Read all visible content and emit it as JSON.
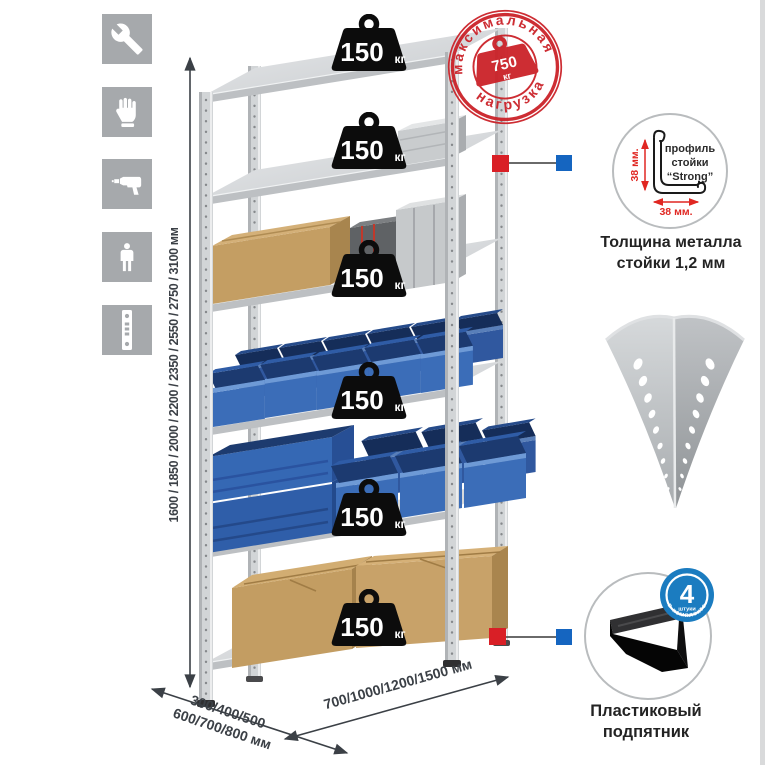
{
  "sidebar": {
    "icons": [
      {
        "id": "wrench",
        "meaning": "wrench tool"
      },
      {
        "id": "gloves",
        "meaning": "work gloves"
      },
      {
        "id": "drill",
        "meaning": "power drill"
      },
      {
        "id": "person",
        "meaning": "assembler person"
      },
      {
        "id": "post",
        "meaning": "perforated post strip"
      }
    ]
  },
  "dimensions": {
    "height": "1600 / 1850 / 2000 / 2200 / 2350 / 2550 / 2750 / 3100 мм",
    "depth_line1": "300/400/500",
    "depth_line2": "600/700/800 мм",
    "width": "700/1000/1200/1500 мм"
  },
  "shelf_load": {
    "value": "150",
    "unit": "кг",
    "shelves_count": 6
  },
  "max_load_stamp": {
    "arc_top": "максимальная",
    "arc_bottom": "нагрузка",
    "value": "750",
    "unit": "кг"
  },
  "profile_detail": {
    "line1": "профиль",
    "line2": "стойки",
    "line3": "“Strong”",
    "dim_vertical": "38 мм.",
    "dim_horizontal": "38 мм.",
    "caption1": "Толщина металла",
    "caption2": "стойки 1,2 мм"
  },
  "foot_detail": {
    "badge_value": "4",
    "badge_unit": "штуки",
    "badge_arc": "в комплекте",
    "caption1": "Пластиковый",
    "caption2": "подпятник"
  },
  "colors": {
    "stamp_red": "#cb2229",
    "marker_red": "#d91f26",
    "marker_blue": "#1565c0",
    "badge_blue": "#1b7cc0",
    "bin_blue": "#3b6db8",
    "metal_gray": "#d2d5d7",
    "icon_bg": "#a6a9ac"
  }
}
